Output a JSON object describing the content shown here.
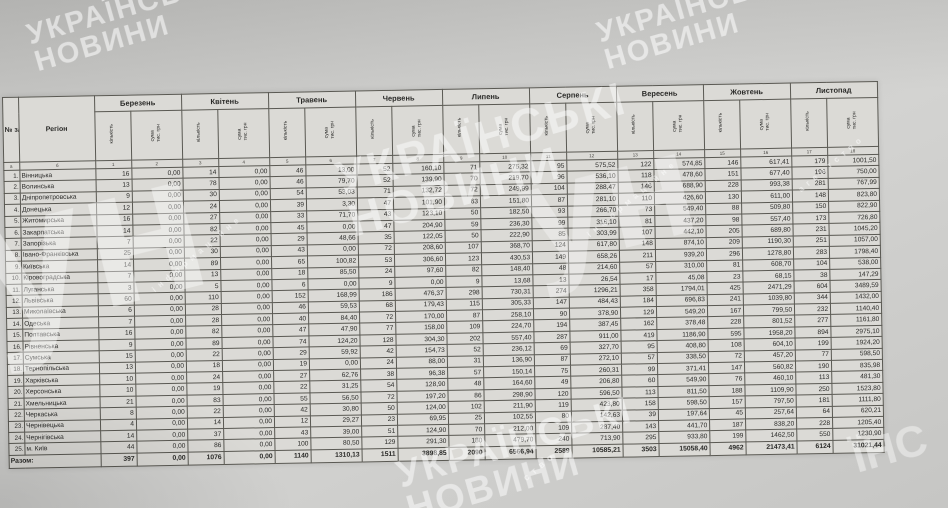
{
  "colors": {
    "paper": "#d7d6d2",
    "ink": "#2a2a28",
    "watermark": "#ffffff"
  },
  "watermark": {
    "line1": "УКРАЇНСЬКІ",
    "line2": "НОВИНИ",
    "logo": "ун",
    "tagline": "інформаційне",
    "tagline2": "агентство",
    "tagline_short": "ство",
    "corner_fragment": "ЇНС"
  },
  "table": {
    "col_num_header": "№ з/п",
    "region_header": "Регіон",
    "months": [
      "Березень",
      "Квітень",
      "Травень",
      "Червень",
      "Липень",
      "Серпень",
      "Вересень",
      "Жовтень",
      "Листопад"
    ],
    "sub_headers": {
      "count": "кількість",
      "sum": "сума, тис. грн"
    },
    "col_numbers": [
      "а",
      "б",
      "1",
      "2",
      "3",
      "4",
      "5",
      "6",
      "7",
      "8",
      "9",
      "10",
      "11",
      "12",
      "13",
      "14",
      "15",
      "16",
      "17",
      "18"
    ],
    "rows": [
      {
        "n": "1.",
        "region": "Вінницька",
        "values": [
          "16",
          "0,00",
          "14",
          "0,00",
          "46",
          "13,00",
          "52",
          "160,10",
          "71",
          "275,32",
          "95",
          "575,52",
          "122",
          "574,85",
          "146",
          "617,41",
          "179",
          "1001,50"
        ]
      },
      {
        "n": "2.",
        "region": "Волинська",
        "values": [
          "13",
          "0,00",
          "78",
          "0,00",
          "46",
          "79,70",
          "52",
          "139,90",
          "70",
          "219,70",
          "96",
          "536,10",
          "118",
          "478,60",
          "151",
          "677,40",
          "196",
          "750,00"
        ]
      },
      {
        "n": "3.",
        "region": "Дніпропетровська",
        "values": [
          "9",
          "0,00",
          "30",
          "0,00",
          "54",
          "53,03",
          "71",
          "132,72",
          "72",
          "249,99",
          "104",
          "288,47",
          "146",
          "688,90",
          "228",
          "993,38",
          "281",
          "767,99"
        ]
      },
      {
        "n": "4.",
        "region": "Донецька",
        "values": [
          "12",
          "0,00",
          "24",
          "0,00",
          "39",
          "3,30",
          "47",
          "101,90",
          "63",
          "151,80",
          "87",
          "281,10",
          "110",
          "426,60",
          "130",
          "611,00",
          "148",
          "823,80"
        ]
      },
      {
        "n": "5.",
        "region": "Житомирська",
        "values": [
          "16",
          "0,00",
          "27",
          "0,00",
          "33",
          "71,70",
          "43",
          "123,10",
          "50",
          "182,50",
          "93",
          "266,70",
          "73",
          "549,40",
          "88",
          "509,80",
          "150",
          "822,90"
        ]
      },
      {
        "n": "6.",
        "region": "Закарпатська",
        "values": [
          "14",
          "0,00",
          "82",
          "0,00",
          "45",
          "0,00",
          "47",
          "204,90",
          "59",
          "236,30",
          "99",
          "316,10",
          "81",
          "437,20",
          "98",
          "557,40",
          "173",
          "726,80"
        ]
      },
      {
        "n": "7.",
        "region": "Запорізька",
        "values": [
          "7",
          "0,00",
          "22",
          "0,00",
          "29",
          "48,66",
          "35",
          "122,05",
          "50",
          "222,90",
          "85",
          "303,99",
          "107",
          "442,10",
          "205",
          "689,80",
          "231",
          "1045,20"
        ]
      },
      {
        "n": "8.",
        "region": "Івано-Франківська",
        "values": [
          "25",
          "0,00",
          "30",
          "0,00",
          "43",
          "0,00",
          "72",
          "208,60",
          "107",
          "368,70",
          "124",
          "617,80",
          "148",
          "874,10",
          "209",
          "1190,30",
          "251",
          "1057,00"
        ]
      },
      {
        "n": "9.",
        "region": "Київська",
        "values": [
          "14",
          "0,00",
          "89",
          "0,00",
          "65",
          "100,82",
          "53",
          "306,60",
          "123",
          "430,53",
          "149",
          "658,26",
          "211",
          "939,20",
          "296",
          "1278,80",
          "283",
          "1798,40"
        ]
      },
      {
        "n": "10.",
        "region": "Кіровоградська",
        "values": [
          "7",
          "0,00",
          "13",
          "0,00",
          "18",
          "85,50",
          "24",
          "97,60",
          "82",
          "148,40",
          "48",
          "214,60",
          "57",
          "310,00",
          "81",
          "608,70",
          "104",
          "538,00"
        ]
      },
      {
        "n": "11.",
        "region": "Луганська",
        "values": [
          "3",
          "0,00",
          "5",
          "0,00",
          "6",
          "0,00",
          "9",
          "0,00",
          "9",
          "13,68",
          "13",
          "26,54",
          "17",
          "45,08",
          "23",
          "68,15",
          "38",
          "147,29"
        ]
      },
      {
        "n": "12.",
        "region": "Львівська",
        "values": [
          "60",
          "0,00",
          "110",
          "0,00",
          "152",
          "168,99",
          "186",
          "476,37",
          "298",
          "730,31",
          "274",
          "1296,21",
          "358",
          "1794,01",
          "425",
          "2471,29",
          "604",
          "3489,59"
        ]
      },
      {
        "n": "13.",
        "region": "Миколаївська",
        "values": [
          "6",
          "0,00",
          "28",
          "0,00",
          "46",
          "59,53",
          "68",
          "179,43",
          "115",
          "305,33",
          "147",
          "484,43",
          "184",
          "696,83",
          "241",
          "1039,80",
          "344",
          "1432,00"
        ]
      },
      {
        "n": "14.",
        "region": "Одеська",
        "values": [
          "7",
          "0,00",
          "28",
          "0,00",
          "40",
          "84,40",
          "72",
          "170,00",
          "87",
          "258,10",
          "90",
          "378,90",
          "129",
          "549,20",
          "167",
          "799,50",
          "232",
          "1140,40"
        ]
      },
      {
        "n": "15.",
        "region": "Полтавська",
        "values": [
          "16",
          "0,00",
          "82",
          "0,00",
          "47",
          "47,90",
          "77",
          "158,00",
          "109",
          "224,70",
          "194",
          "387,45",
          "162",
          "378,48",
          "228",
          "801,52",
          "277",
          "1161,80"
        ]
      },
      {
        "n": "16.",
        "region": "Рівненська",
        "values": [
          "9",
          "0,00",
          "89",
          "0,00",
          "74",
          "124,20",
          "128",
          "304,30",
          "202",
          "557,40",
          "287",
          "911,00",
          "419",
          "1186,90",
          "595",
          "1958,20",
          "894",
          "2975,10"
        ]
      },
      {
        "n": "17.",
        "region": "Сумська",
        "values": [
          "15",
          "0,00",
          "22",
          "0,00",
          "29",
          "59,92",
          "42",
          "154,73",
          "52",
          "236,12",
          "69",
          "327,70",
          "95",
          "408,80",
          "108",
          "604,10",
          "199",
          "1924,20"
        ]
      },
      {
        "n": "18.",
        "region": "Тернопільська",
        "values": [
          "13",
          "0,00",
          "18",
          "0,00",
          "19",
          "0,00",
          "24",
          "88,00",
          "31",
          "136,90",
          "87",
          "272,10",
          "57",
          "338,50",
          "72",
          "457,20",
          "77",
          "598,50"
        ]
      },
      {
        "n": "19.",
        "region": "Харківська",
        "values": [
          "10",
          "0,00",
          "24",
          "0,00",
          "27",
          "62,76",
          "38",
          "96,38",
          "57",
          "150,14",
          "75",
          "260,31",
          "99",
          "371,41",
          "147",
          "560,82",
          "190",
          "835,98"
        ]
      },
      {
        "n": "20.",
        "region": "Херсонська",
        "values": [
          "10",
          "0,00",
          "19",
          "0,00",
          "22",
          "31,25",
          "54",
          "128,90",
          "48",
          "164,60",
          "49",
          "206,80",
          "60",
          "549,90",
          "76",
          "460,10",
          "113",
          "481,30"
        ]
      },
      {
        "n": "21.",
        "region": "Хмельницька",
        "values": [
          "21",
          "0,00",
          "83",
          "0,00",
          "55",
          "56,50",
          "72",
          "197,20",
          "86",
          "298,90",
          "120",
          "596,50",
          "113",
          "811,50",
          "188",
          "1109,90",
          "250",
          "1523,80"
        ]
      },
      {
        "n": "22.",
        "region": "Черкаська",
        "values": [
          "8",
          "0,00",
          "22",
          "0,00",
          "42",
          "30,80",
          "50",
          "124,00",
          "102",
          "211,90",
          "119",
          "423,80",
          "158",
          "598,50",
          "157",
          "797,50",
          "181",
          "1111,80"
        ]
      },
      {
        "n": "23.",
        "region": "Чернівецька",
        "values": [
          "4",
          "0,00",
          "14",
          "0,00",
          "12",
          "29,27",
          "23",
          "69,95",
          "25",
          "102,55",
          "80",
          "142,63",
          "39",
          "197,64",
          "45",
          "257,64",
          "64",
          "620,21"
        ]
      },
      {
        "n": "24.",
        "region": "Чернігівська",
        "values": [
          "14",
          "0,00",
          "37",
          "0,00",
          "43",
          "39,00",
          "51",
          "124,90",
          "70",
          "212,00",
          "109",
          "287,40",
          "143",
          "441,70",
          "187",
          "838,20",
          "228",
          "1205,40"
        ]
      },
      {
        "n": "25.",
        "region": "м. Київ",
        "values": [
          "44",
          "0,00",
          "86",
          "0,00",
          "100",
          "80,50",
          "129",
          "291,30",
          "180",
          "479,70",
          "240",
          "713,90",
          "295",
          "933,80",
          "199",
          "1462,50",
          "550",
          "1230,90"
        ]
      }
    ],
    "total": {
      "label": "Разом:",
      "values": [
        "397",
        "0,00",
        "1076",
        "0,00",
        "1140",
        "1310,13",
        "1511",
        "3898,85",
        "2090",
        "6566,94",
        "2589",
        "10585,21",
        "3503",
        "15058,40",
        "4962",
        "21473,41",
        "6124",
        "31021,44"
      ]
    }
  }
}
